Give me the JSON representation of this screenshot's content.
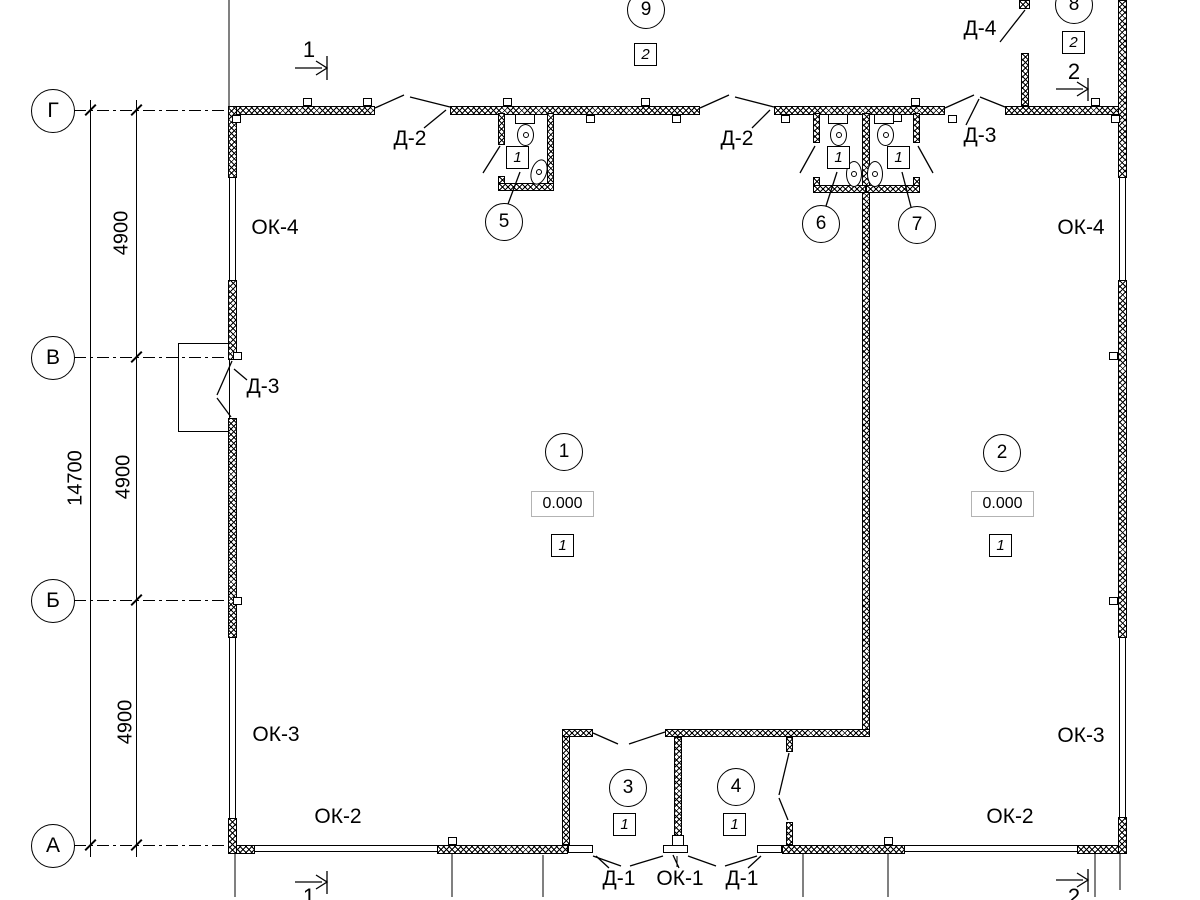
{
  "axes": {
    "row_labels": [
      "Г",
      "В",
      "Б",
      "А"
    ]
  },
  "dimensions": {
    "overall": "14700",
    "bay": "4900"
  },
  "sections": {
    "one": "1",
    "two": "2"
  },
  "rooms": [
    {
      "num": "1",
      "level": "0.000",
      "floor": "1"
    },
    {
      "num": "2",
      "level": "0.000",
      "floor": "1"
    },
    {
      "num": "3",
      "floor": "1"
    },
    {
      "num": "4",
      "floor": "1"
    },
    {
      "num": "5",
      "floor": "1"
    },
    {
      "num": "6",
      "floor": "1"
    },
    {
      "num": "7",
      "floor": "1"
    },
    {
      "num": "8",
      "floor": "2"
    },
    {
      "num": "9",
      "floor": "2"
    }
  ],
  "doors": {
    "d1": "Д-1",
    "d2": "Д-2",
    "d3": "Д-3",
    "d4": "Д-4"
  },
  "windows": {
    "ok1": "ОК-1",
    "ok2": "ОК-2",
    "ok3": "ОК-3",
    "ok4": "ОК-4"
  },
  "colors": {
    "line": "#000000",
    "background": "#ffffff",
    "level_border": "#b3b3b3"
  }
}
